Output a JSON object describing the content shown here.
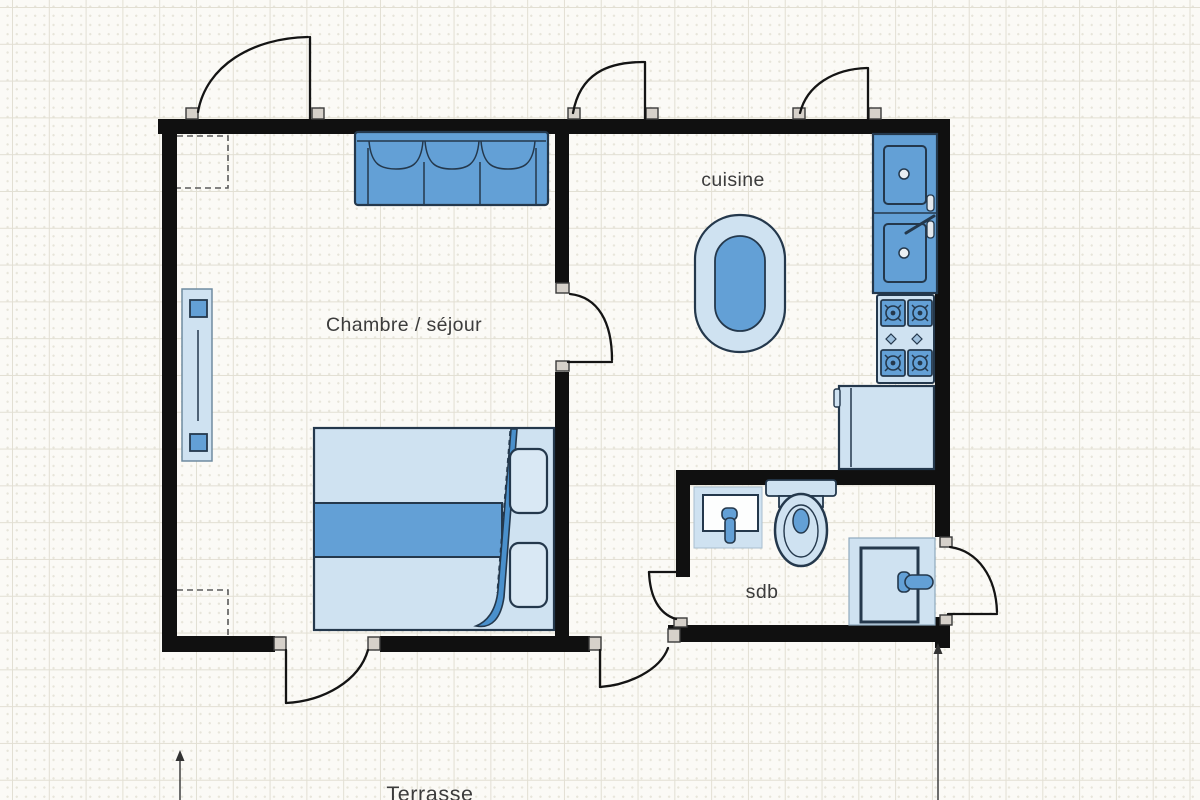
{
  "canvas": {
    "width_px": 1200,
    "height_px": 800,
    "background": "#fbfaf6",
    "grid_line_color": "#e2dfd3",
    "grid_dot_color": "#e7e5da",
    "grid_cell_px": 37
  },
  "labels": {
    "bedroom_living": "Chambre / séjour",
    "kitchen": "cuisine",
    "bathroom": "sdb",
    "terrace": "Terrasse"
  },
  "colors": {
    "wall": "#101010",
    "furniture_light_blue": "#cfe2f1",
    "furniture_mid_blue": "#63a0d6",
    "furniture_outline": "#24384c",
    "blanket_fold_blue": "#4a90cc",
    "door_jamb": "#d6d1ca",
    "label_text": "#3c3c3c"
  },
  "rooms": [
    {
      "name": "bedroom-living",
      "label": "Chambre / séjour"
    },
    {
      "name": "kitchen",
      "label": "cuisine"
    },
    {
      "name": "bathroom",
      "label": "sdb"
    },
    {
      "name": "terrace",
      "label": "Terrasse"
    }
  ],
  "furniture": [
    {
      "name": "sofa-3-seats",
      "room": "bedroom-living"
    },
    {
      "name": "double-bed",
      "room": "bedroom-living"
    },
    {
      "name": "radiator",
      "room": "bedroom-living"
    },
    {
      "name": "closet-dashed-top",
      "room": "bedroom-living"
    },
    {
      "name": "closet-dashed-bottom",
      "room": "bedroom-living"
    },
    {
      "name": "oval-table",
      "room": "kitchen"
    },
    {
      "name": "double-sink-counter",
      "room": "kitchen"
    },
    {
      "name": "stove-4-burners",
      "room": "kitchen"
    },
    {
      "name": "fridge",
      "room": "kitchen"
    },
    {
      "name": "washbasin",
      "room": "bathroom"
    },
    {
      "name": "toilet",
      "room": "bathroom"
    },
    {
      "name": "shower",
      "room": "bathroom"
    }
  ],
  "doors": [
    {
      "name": "door-entrance-top-left",
      "wall": "top"
    },
    {
      "name": "door-kitchen-top",
      "wall": "top"
    },
    {
      "name": "door-kitchen-top-right",
      "wall": "top"
    },
    {
      "name": "door-living-to-kitchen",
      "wall": "interior"
    },
    {
      "name": "door-terrace-left",
      "wall": "bottom"
    },
    {
      "name": "door-terrace-right",
      "wall": "bottom"
    },
    {
      "name": "door-bathroom",
      "wall": "bathroom-left"
    },
    {
      "name": "door-exterior-right",
      "wall": "right"
    }
  ],
  "annotations": [
    {
      "name": "dimension-arrow-left"
    },
    {
      "name": "dimension-arrow-right"
    }
  ]
}
